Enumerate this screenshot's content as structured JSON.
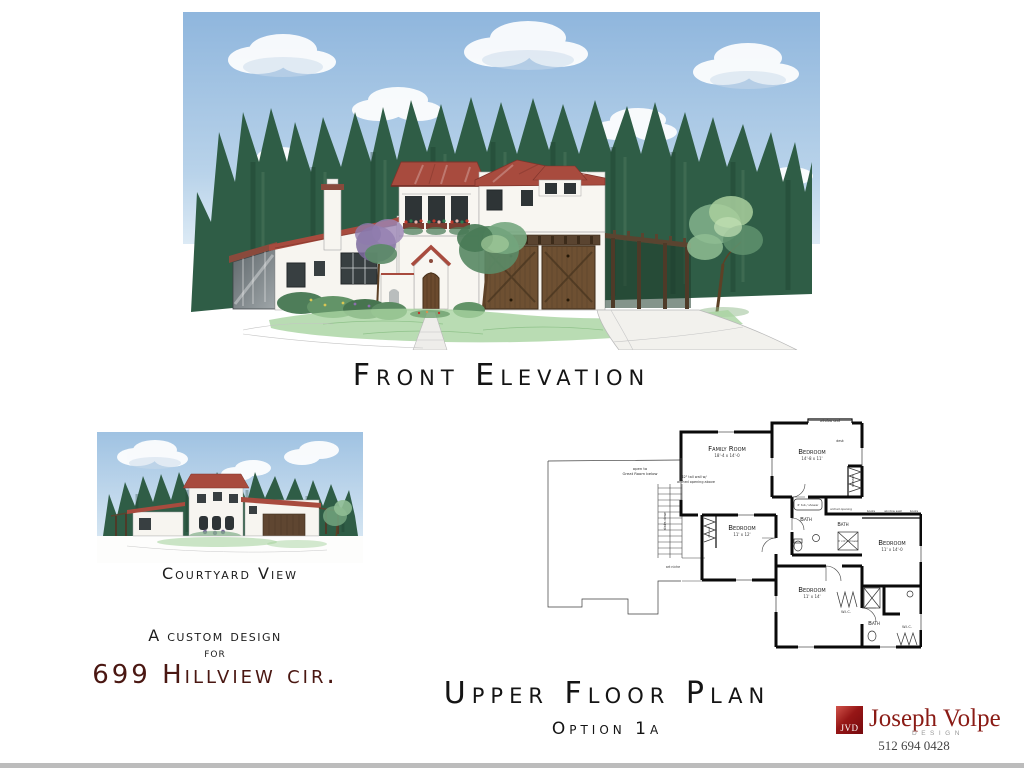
{
  "front_elevation": {
    "title": "Front Elevation"
  },
  "courtyard": {
    "caption": "Courtyard View"
  },
  "project": {
    "tagline_line1": "A custom design",
    "tagline_line2": "for",
    "address": "699 Hillview cir."
  },
  "floor_plan": {
    "title": "Upper Floor Plan",
    "option": "Option 1a",
    "labels": {
      "family_room": "Family Room",
      "family_room_dim": "18'-4 x 14'-0",
      "bedroom": "Bedroom",
      "bedroom_top_dim": "14'-8 x 11'",
      "bedroom_mid_dim": "11' x 12'",
      "bedroom_right_dim": "11' x 14'-0",
      "bedroom_bottom_dim": "11' x 14'",
      "bath": "Bath",
      "wic": "W.I.C.",
      "open_to": "open to",
      "great_room_below": "Great Room below",
      "wall_note_1": "42\" tall wall w/",
      "wall_note_2": "arched opening above",
      "window_seat": "window seat",
      "desk": "desk",
      "dresser": "dresser",
      "books": "books",
      "stairs_down": "stairs down",
      "art_niche": "art niche",
      "tub_shower": "6' tub / shower",
      "shower": "4' x 6'-4 shower",
      "arched_opening": "arched opening"
    }
  },
  "logo": {
    "initials": "JVD",
    "name": "Joseph Volpe",
    "subtitle": "DESIGN",
    "phone": "512 694 0428"
  },
  "colors": {
    "accent_maroon": "#4a1712",
    "logo_red": "#961616",
    "roof_red": "#a84b3e",
    "tree_green": "#2f5d46",
    "sky_blue": "#9fc2e2",
    "wood_brown": "#6e5032",
    "lawn_green": "#a8d3a0"
  }
}
